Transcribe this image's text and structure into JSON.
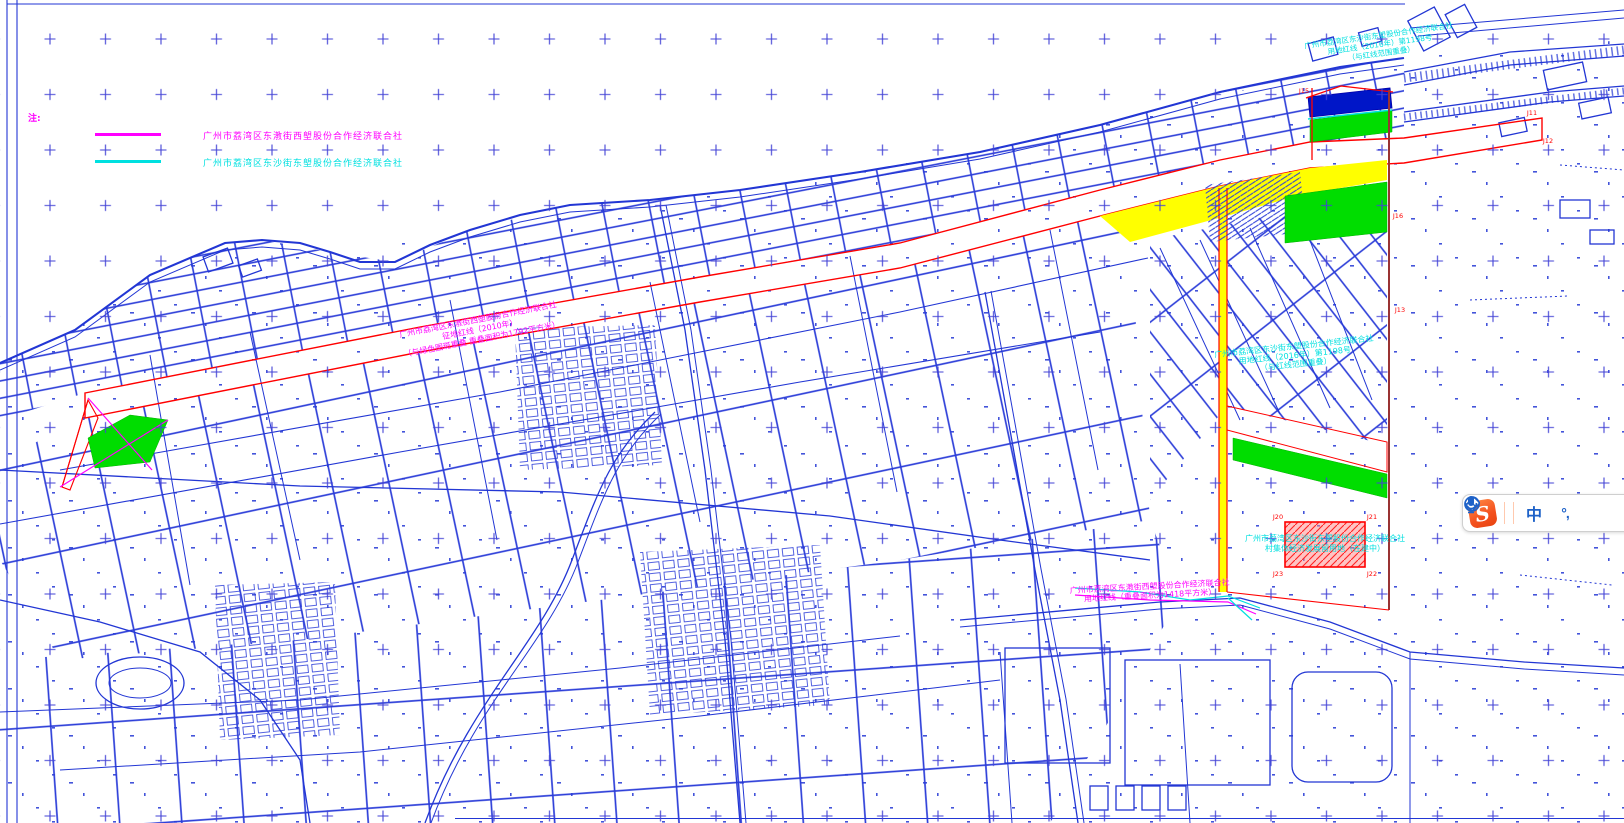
{
  "app": {
    "type": "cad-map-viewer",
    "background": "#ffffff"
  },
  "legend": {
    "note": "注:",
    "items": [
      {
        "color": "#ff00ff",
        "label": "广州市荔湾区东漖街西塱股份合作经济联合社"
      },
      {
        "color": "#00e0e0",
        "label": "广州市荔湾区东沙街东塱股份合作经济联合社"
      }
    ]
  },
  "annotations": {
    "band_label": {
      "line1": "广州市荔湾区东漖街西塱股份合作经济联合社",
      "line2": "征地红线（2010年）",
      "line3": "（与绿色图斑重叠 重叠面积为1792平方米）"
    },
    "right_label": {
      "line1": "广州市荔湾区东沙街东塱股份合作经济联合社",
      "line2": "用地红线（2016年）第1198号",
      "line3": "（与红线范围重叠）"
    },
    "topright_label": {
      "line1": "广州市荔湾区东沙街东塱股份合作经济联合社",
      "line2": "用地红线（2016年）第1198号",
      "line3": "（与红线范围重叠）"
    },
    "parcel_label": {
      "line1": "广州市荔湾区东沙街东塱股份合作经济联合社",
      "line2": "村集体经济发展留用地（在建中）"
    },
    "bottom_label": {
      "line1": "广州市荔湾区东漖街西塱股份合作经济联合社",
      "line2": "用地红线（重叠面积为1418平方米）"
    }
  },
  "vertex_labels": {
    "j11": "J11",
    "j12": "J12",
    "j13": "J13",
    "j15": "J15",
    "j16": "J16",
    "j20": "J20",
    "j21": "J21",
    "j22": "J22",
    "j23": "J23"
  },
  "toolbar": {
    "name": "Sogou input method bar",
    "logo_text": "S",
    "mode_label": "中",
    "punctuation_label": "°,",
    "buttons": [
      "chinese-mode",
      "punctuation-mode",
      "emoji",
      "skin-eraser",
      "microphone"
    ]
  },
  "colors": {
    "line_blue": "#2236d4",
    "cross_blue": "#4343d6",
    "highlight_yellow": "#ffff00",
    "highlight_green": "#00dd00",
    "boundary_red": "#ff0000",
    "dark_red": "#993333",
    "deep_blue": "#0016c8",
    "magenta": "#ff00ff",
    "cyan": "#00e0e0",
    "sogou_orange": "#f4511e",
    "icon_blue": "#1e62c8"
  }
}
